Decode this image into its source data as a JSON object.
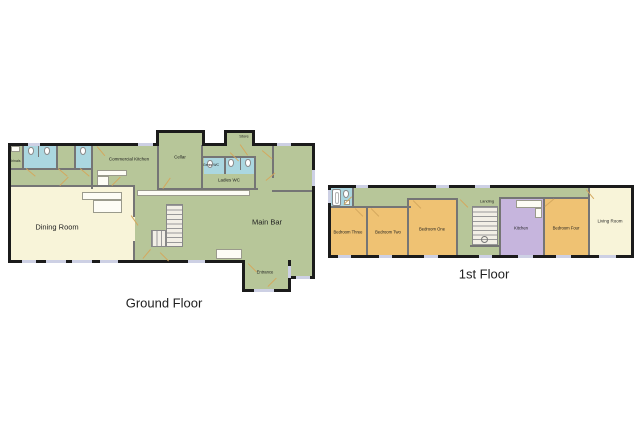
{
  "palette": {
    "room_green": "#b7c699",
    "room_cream": "#f8f4d9",
    "room_orange": "#efc273",
    "room_purple": "#c6b5dd",
    "room_blue": "#abd7e0",
    "wall_external": "#1b1b1b",
    "wall_internal": "#757575",
    "window": "#cdd0e4",
    "door": "#d4a85e",
    "background": "#ffffff"
  },
  "icons": {
    "toilet": "css-rounded-shape",
    "bathtub": "css-rect-with-inner-border",
    "stairs": "css-striped-rect",
    "door_swing": "css-diagonal-line",
    "window": "css-light-rect"
  },
  "floors": [
    {
      "title": "Ground Floor",
      "rooms": [
        {
          "label": "Urinals"
        },
        {
          "label": "Commercial Kitchen"
        },
        {
          "label": "Cellar"
        },
        {
          "label": "Gents WC"
        },
        {
          "label": "Ladies WC"
        },
        {
          "label": "Store"
        },
        {
          "label": "Dining Room"
        },
        {
          "label": "Main Bar"
        },
        {
          "label": "Entrance"
        }
      ]
    },
    {
      "title": "1st Floor",
      "rooms": [
        {
          "label": "Bedroom Three"
        },
        {
          "label": "Bedroom Two"
        },
        {
          "label": "Bedroom One"
        },
        {
          "label": "Landing"
        },
        {
          "label": "Kitchen"
        },
        {
          "label": "Bedroom Four"
        },
        {
          "label": "Living Room"
        }
      ]
    }
  ]
}
